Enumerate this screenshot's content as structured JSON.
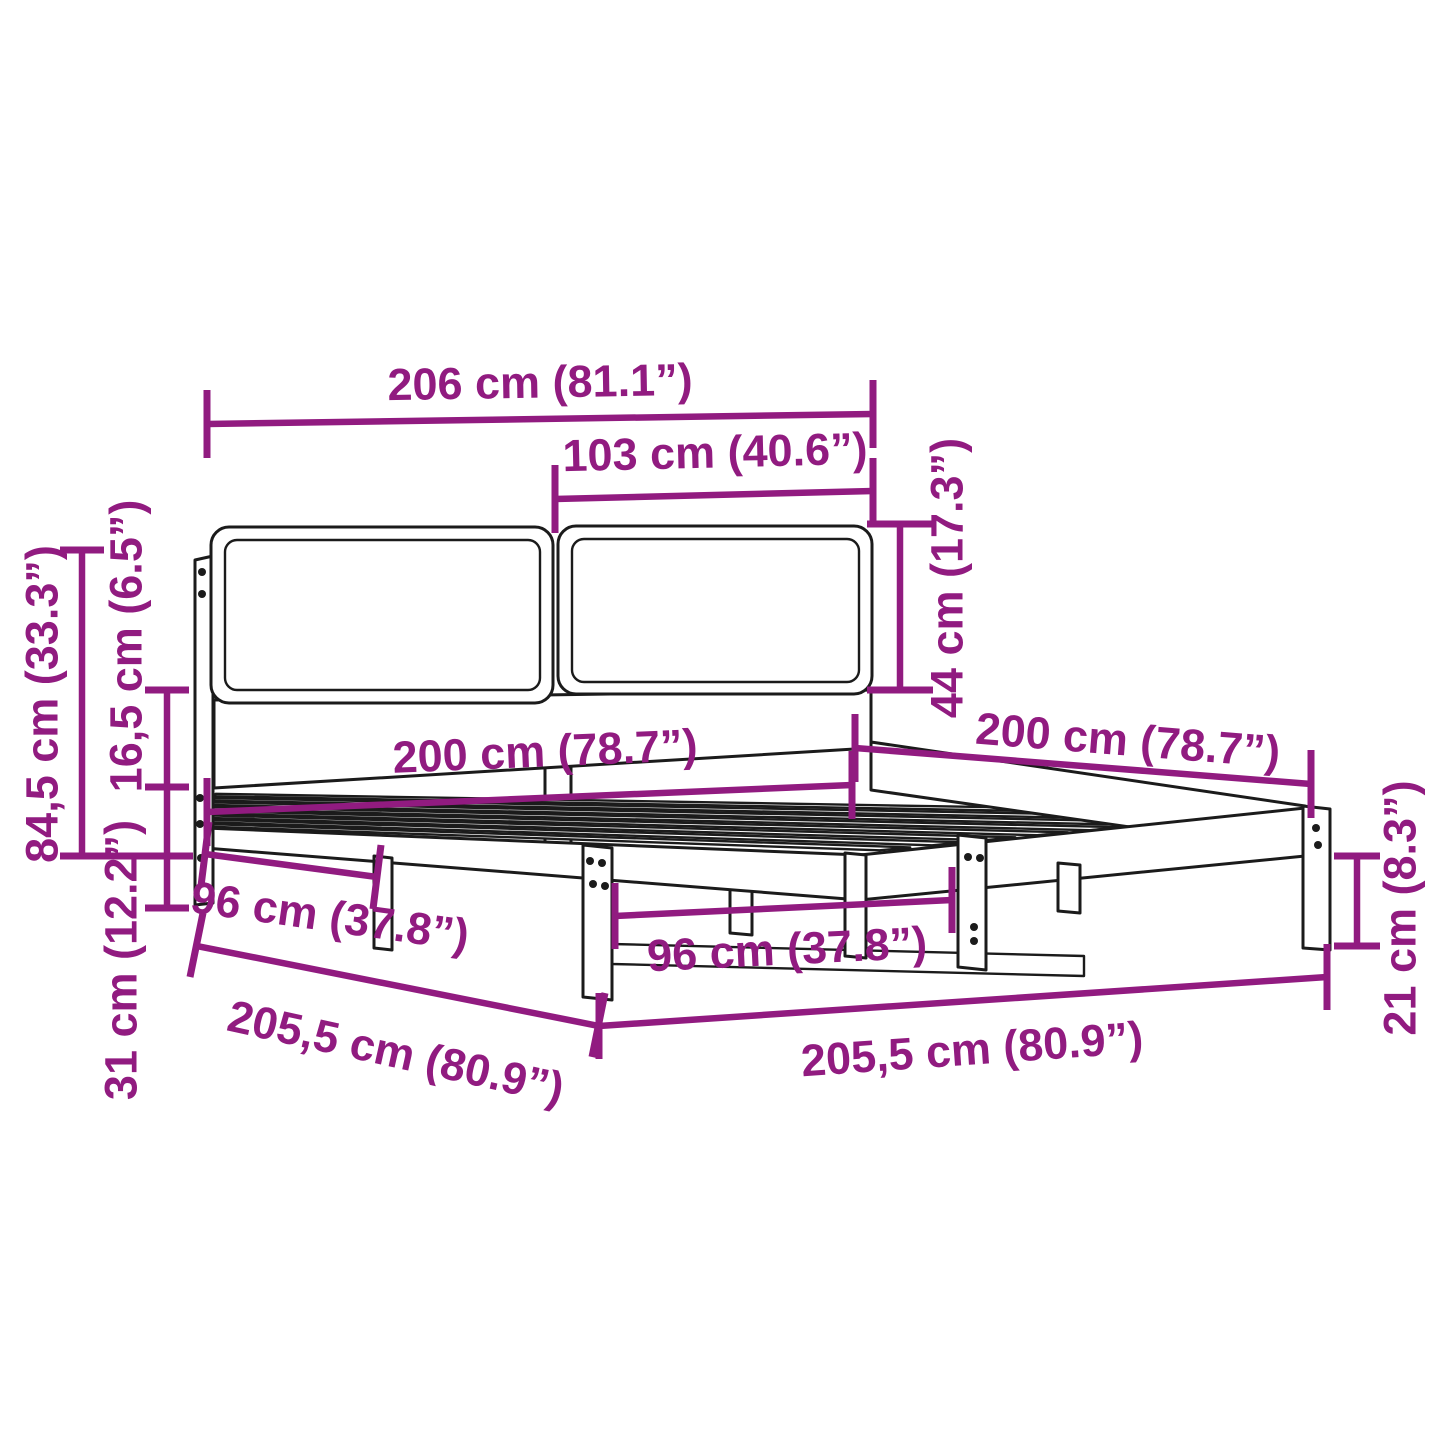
{
  "diagram": {
    "type": "product-dimension-diagram",
    "subject": "bed-frame-with-headboard"
  },
  "colors": {
    "dimension": "#911b80",
    "drawing": "#1b1b1b",
    "background": "#ffffff"
  },
  "dimensions": [
    {
      "id": "overall-width-top",
      "label": "206 cm (81.1”)"
    },
    {
      "id": "headboard-panel-width",
      "label": "103 cm (40.6”)"
    },
    {
      "id": "headboard-panel-height",
      "label": "44 cm (17.3”)"
    },
    {
      "id": "bed-width",
      "label": "200 cm (78.7”)"
    },
    {
      "id": "bed-length",
      "label": "200 cm (78.7”)"
    },
    {
      "id": "overall-height",
      "label": "84,5 cm (33.3”)"
    },
    {
      "id": "headboard-clearance",
      "label": "16,5 cm (6.5”)"
    },
    {
      "id": "frame-base-height",
      "label": "31 cm (12.2”)"
    },
    {
      "id": "leg-spacing-left",
      "label": "96 cm (37.8”)"
    },
    {
      "id": "leg-spacing-center",
      "label": "96 cm (37.8”)"
    },
    {
      "id": "frame-length-left",
      "label": "205,5 cm (80.9”)"
    },
    {
      "id": "frame-length-bottom",
      "label": "205,5 cm (80.9”)"
    },
    {
      "id": "leg-height",
      "label": "21 cm (8.3”)"
    }
  ]
}
